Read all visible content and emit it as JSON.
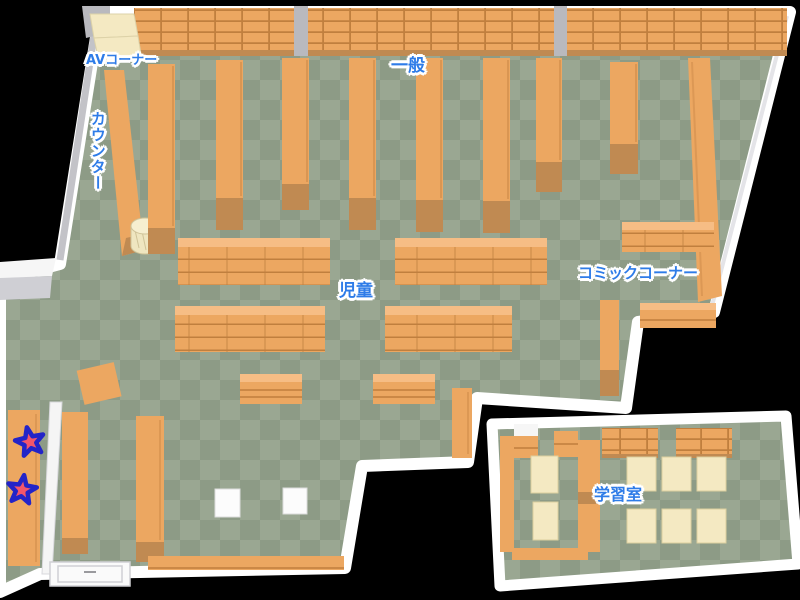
{
  "map": {
    "labels": {
      "av_corner": "AVコーナー",
      "counter": "カウンター",
      "general": "一般",
      "children": "児童",
      "comic_corner": "コミックコーナー",
      "study_room": "学習室"
    },
    "markers": {
      "star_count": 2
    },
    "colors": {
      "floor_light": "#9aa792",
      "floor_dark": "#8d9b86",
      "shelf": "#eca761",
      "shelf_light": "#f6bd85",
      "shelf_dark": "#c08a52",
      "shelf_line": "#c07f3e",
      "wall": "#ffffff",
      "wall_shade": "#c3c3c8",
      "desk": "#f4e9c2",
      "label_blue": "#2e7ce8",
      "star_red": "#f2566b",
      "star_blue": "#2324c8"
    }
  }
}
